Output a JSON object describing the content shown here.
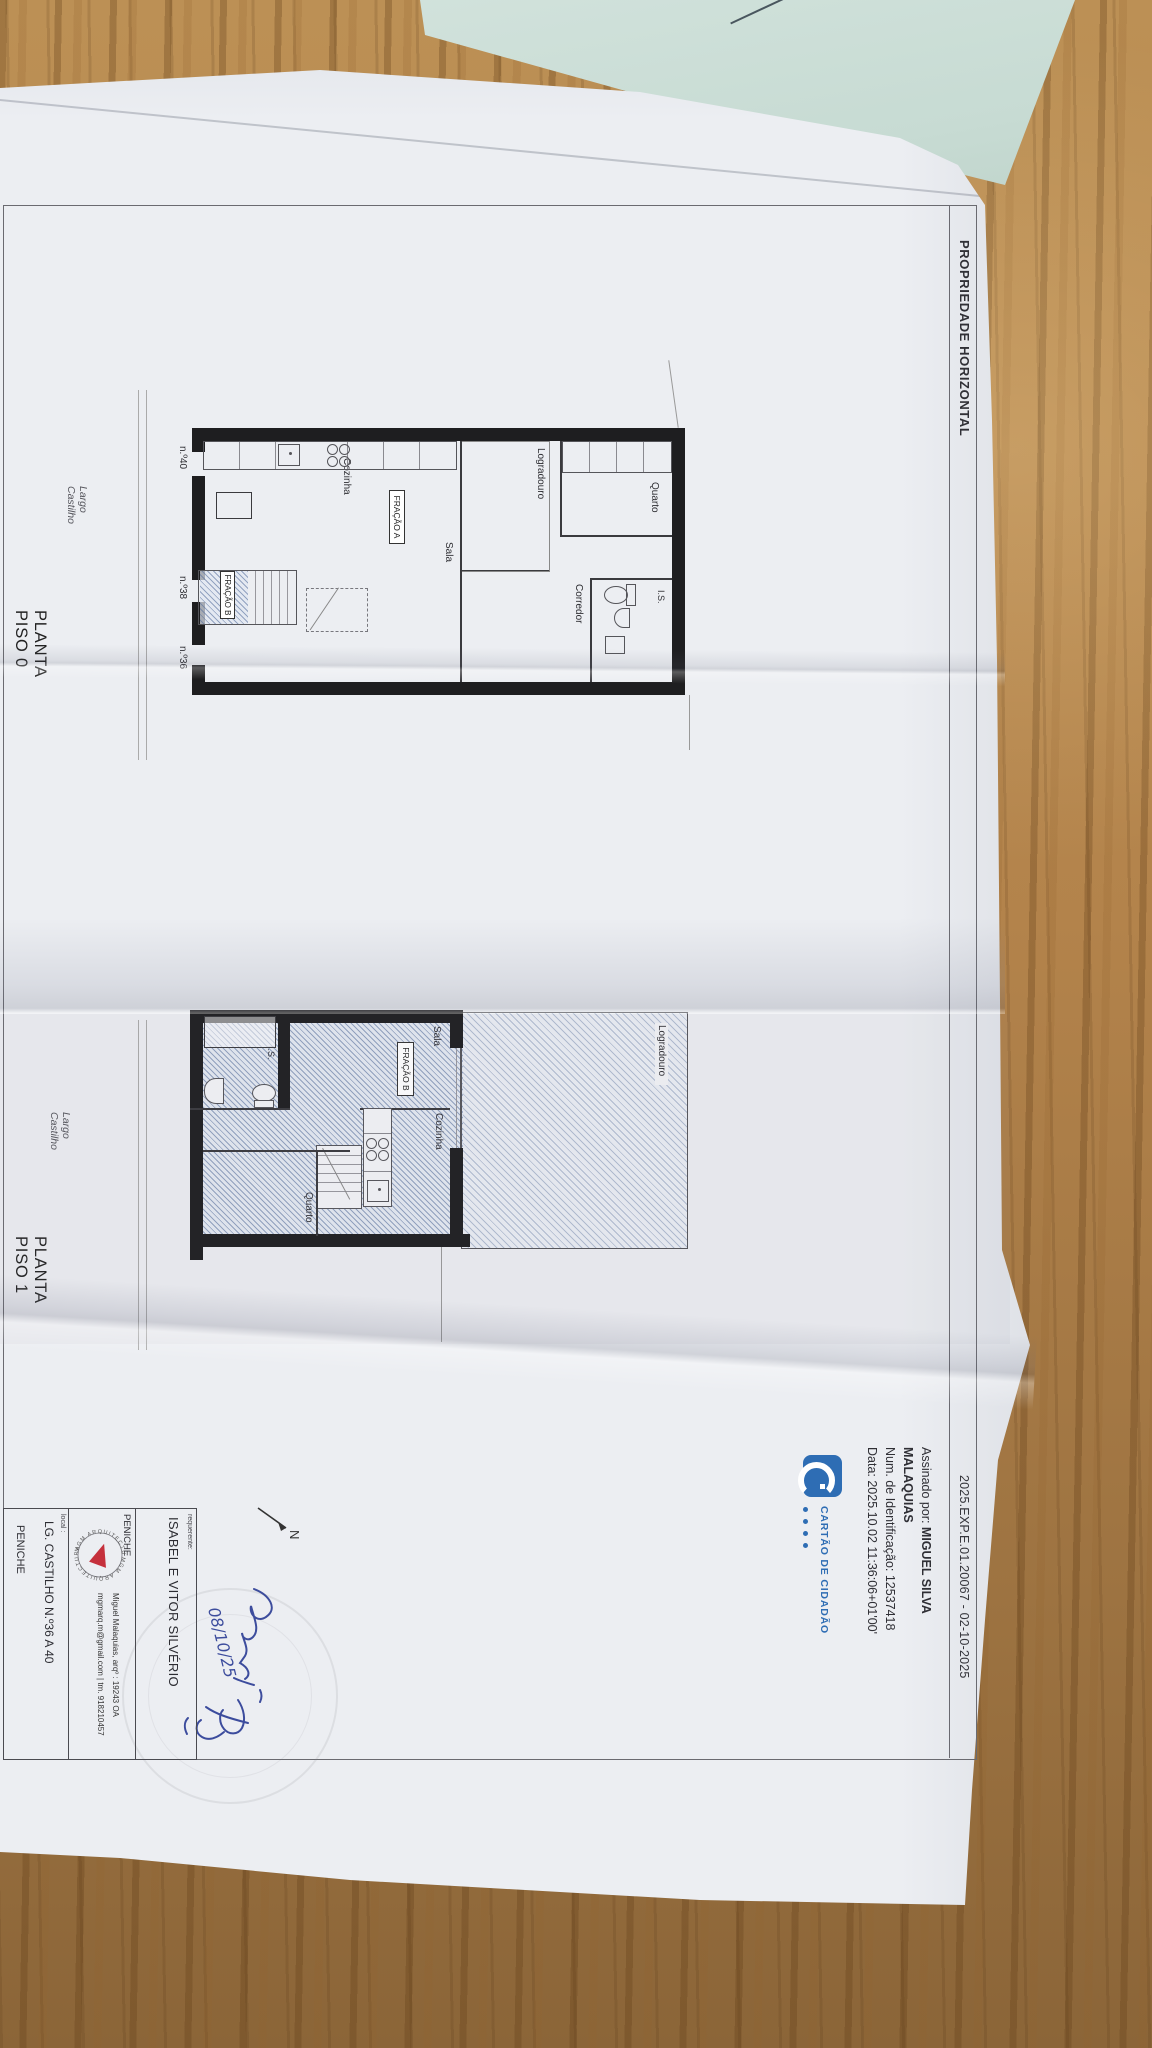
{
  "header": {
    "title": "PROPRIEDADE HORIZONTAL",
    "ref": "2025.EXP.E.01.20067 - 02-10-2025"
  },
  "signature": {
    "assinado_label": "Assinado por:",
    "name_line1": "MIGUEL SILVA",
    "name_line2": "MALAQUIAS",
    "id_line": "Num. de Identificação: 12537418",
    "date_line": "Data: 2025.10.02 11:36:06+01'00'",
    "cc_label": "CARTÃO DE CIDADÃO",
    "cc_blue": "#2e6db4"
  },
  "plan0": {
    "title": "PLANTA PISO 0",
    "street": "Largo Castilho",
    "rooms": {
      "quarto": "Quarto",
      "is": "I.S.",
      "corredor": "Corredor",
      "logradouro": "Logradouro",
      "sala": "Sala",
      "cozinha": "Cozinha"
    },
    "fracao_a": "FRAÇÃO A",
    "fracao_b": "FRAÇÃO B",
    "numbers": {
      "n40": "n.º40",
      "n38": "n.º38",
      "n36": "n.º36"
    }
  },
  "plan1": {
    "title": "PLANTA PISO 1",
    "street": "Largo Castilho",
    "rooms": {
      "logradouro": "Logradouro",
      "sala": "Sala",
      "cozinha": "Cozinha",
      "quarto": "Quarto",
      "is": "I.S."
    },
    "fracao_b": "FRAÇÃO B"
  },
  "north": {
    "label": "N"
  },
  "handwriting": {
    "date": "08/10/25",
    "ink_color": "#2e3f96"
  },
  "titleblock": {
    "requerente_label": "requerente:",
    "requerente": "ISABEL E VITOR SILVÉRIO",
    "city": "PENICHE",
    "logo_text": "MGM ARQUITECTURA",
    "architect_line1": "Miguel Malaquias, arqº  :  19243 OA",
    "architect_line2": "mgmarq.m@gmail.com  |  tm. 918210457",
    "local_label": "local :",
    "address": "LG. CASTILHO N.º36 A 40",
    "city_bottom": "PENICHE"
  }
}
